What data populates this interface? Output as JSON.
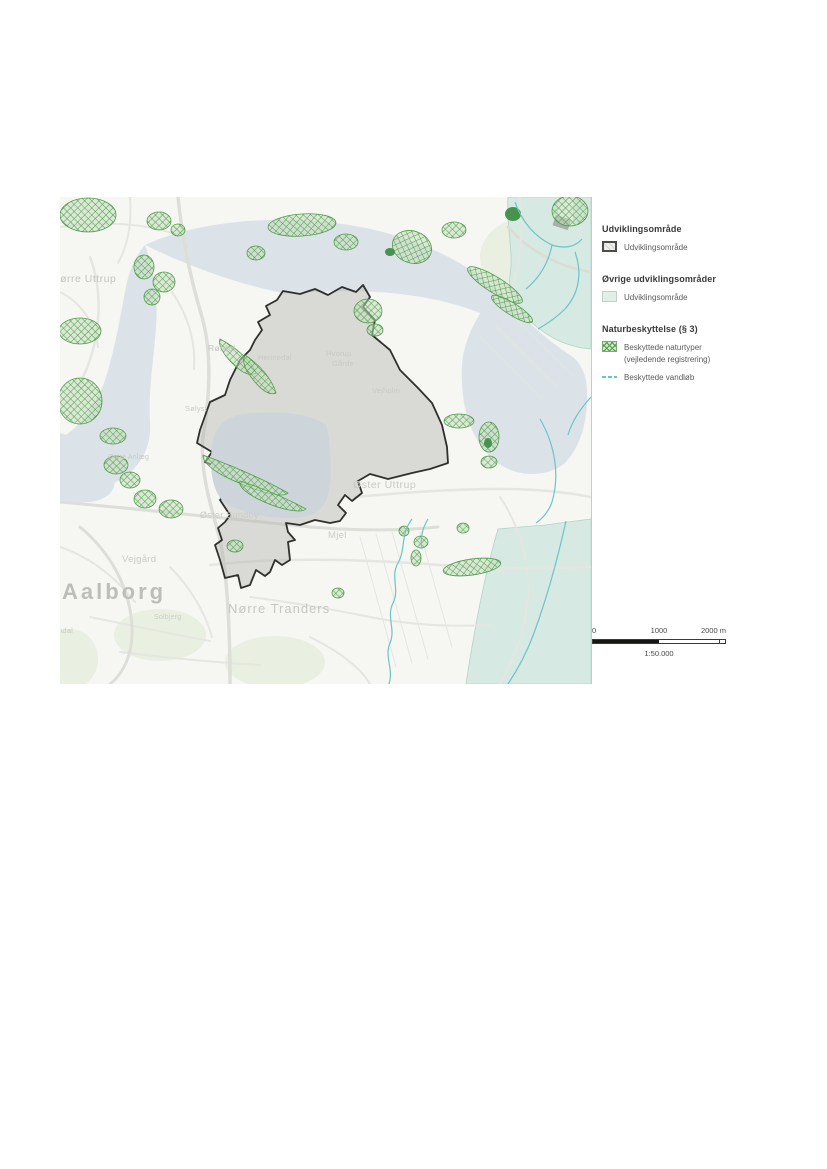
{
  "colors": {
    "water": "#dce3e8",
    "quarry_lake": "#cdd5db",
    "land": "#f6f6f3",
    "nature_green": "#4f9c49",
    "teal_area": "#d7e9e3",
    "stream_cyan": "#6cc4c6",
    "dev_area_stroke": "#2f2f2d",
    "dev_area_fill": "#e2e2df"
  },
  "legend": {
    "sections": [
      {
        "title": "Udviklingsområde",
        "items": [
          {
            "swatch": "udviklingsomraade",
            "lines": [
              "Udviklingsområde"
            ]
          }
        ]
      },
      {
        "title": "Øvrige udviklingsområder",
        "items": [
          {
            "swatch": "oevrige-udviklingsomraade",
            "lines": [
              "Udviklingsområde"
            ]
          }
        ]
      },
      {
        "title": "Naturbeskyttelse (§ 3)",
        "items": [
          {
            "swatch": "beskyttede-naturtyper",
            "lines": [
              "Beskyttede naturtyper",
              "(vejledende registrering)"
            ]
          },
          {
            "swatch": "beskyttede-vandloeb",
            "lines": [
              "Beskyttede vandløb"
            ]
          }
        ]
      }
    ]
  },
  "scalebar": {
    "tick_labels": [
      "0",
      "1000",
      "2000 m"
    ],
    "ratio_label": "1:50.000"
  },
  "map": {
    "place_labels": [
      {
        "text": "Aalborg",
        "x": 2,
        "y": 384,
        "size": 22,
        "weight": "bold",
        "color": "#bdbdb9",
        "spacing": 3
      },
      {
        "text": "Nørre Tranders",
        "x": 168,
        "y": 405,
        "size": 13,
        "weight": "normal",
        "color": "#c6c6c2",
        "spacing": 1
      },
      {
        "text": "Nørre Uttrup",
        "x": -8,
        "y": 77,
        "size": 10.5,
        "weight": "normal",
        "color": "#c3c3bf",
        "spacing": 0.5
      },
      {
        "text": "Øster Uttrup",
        "x": 293,
        "y": 283,
        "size": 10.5,
        "weight": "normal",
        "color": "#c8c8c4",
        "spacing": 0.5
      },
      {
        "text": "Øster Sundby",
        "x": 140,
        "y": 314,
        "size": 9,
        "weight": "normal",
        "color": "#cbcbc7",
        "spacing": 0.3
      },
      {
        "text": "Vejgård",
        "x": 62,
        "y": 358,
        "size": 9.5,
        "weight": "normal",
        "color": "#c9c9c5",
        "spacing": 0.3
      },
      {
        "text": "Mjel",
        "x": 268,
        "y": 334,
        "size": 9.5,
        "weight": "normal",
        "color": "#cbcbc7",
        "spacing": 0.3
      },
      {
        "text": "Rørdal",
        "x": 148,
        "y": 147,
        "size": 8.5,
        "weight": "normal",
        "color": "#c3c3bf",
        "spacing": 0.3
      },
      {
        "text": "Hennedal",
        "x": 198,
        "y": 157,
        "size": 7.5,
        "weight": "normal",
        "color": "#c8c8c4",
        "spacing": 0.2
      },
      {
        "text": "Hvorup",
        "x": 266,
        "y": 153,
        "size": 7.5,
        "weight": "normal",
        "color": "#c8c8c4",
        "spacing": 0.2
      },
      {
        "text": "Gårde",
        "x": 272,
        "y": 163,
        "size": 7.5,
        "weight": "normal",
        "color": "#c8c8c4",
        "spacing": 0.2
      },
      {
        "text": "Vejholm",
        "x": 312,
        "y": 190,
        "size": 7.5,
        "weight": "normal",
        "color": "#c9c9c5",
        "spacing": 0.2
      },
      {
        "text": "Sølyst",
        "x": 125,
        "y": 208,
        "size": 7.5,
        "weight": "normal",
        "color": "#cbcbc7",
        "spacing": 0.2
      },
      {
        "text": "Østre Anlæg",
        "x": 48,
        "y": 257,
        "size": 7,
        "weight": "normal",
        "color": "#c9c9c5",
        "spacing": 0.2
      },
      {
        "text": "Solbjerg",
        "x": 94,
        "y": 417,
        "size": 7,
        "weight": "normal",
        "color": "#cdcdc9",
        "spacing": 0.2
      },
      {
        "text": "ndal",
        "x": -2,
        "y": 430,
        "size": 7.5,
        "weight": "normal",
        "color": "#c9c9c5",
        "spacing": 0.2
      }
    ]
  }
}
